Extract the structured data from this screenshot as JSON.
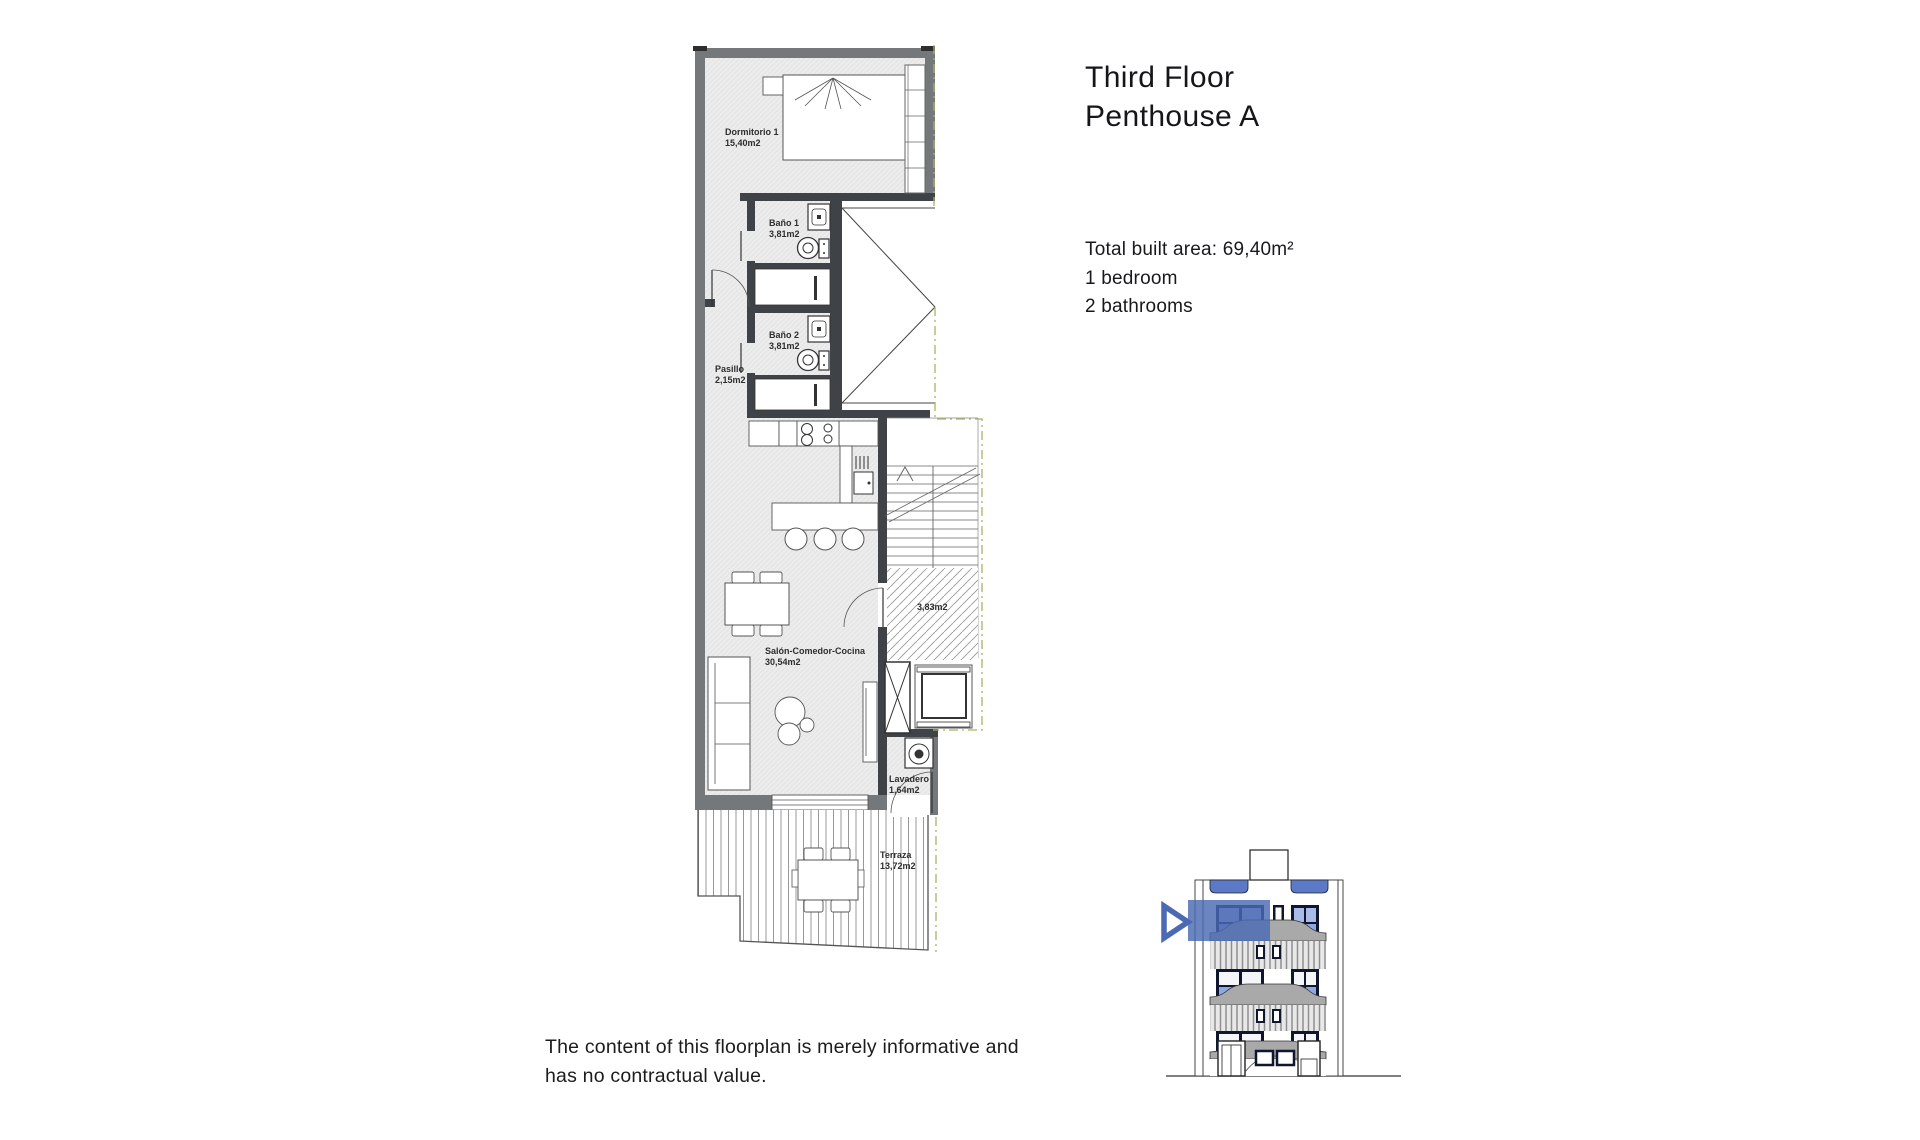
{
  "page": {
    "background": "#ffffff"
  },
  "header": {
    "title_line1": "Third Floor",
    "title_line2": "Penthouse A"
  },
  "summary": {
    "total_area": "Total built area: 69,40m²",
    "bedrooms": "1 bedroom",
    "bathrooms": "2 bathrooms"
  },
  "disclaimer": {
    "line1": "The content of this floorplan is merely informative and",
    "line2": "has no contractual value."
  },
  "floorplan": {
    "rooms": {
      "dormitorio1": {
        "name": "Dormitorio 1",
        "area": "15,40m2"
      },
      "bano1": {
        "name": "Baño 1",
        "area": "3,81m2"
      },
      "bano2": {
        "name": "Baño 2",
        "area": "3,81m2"
      },
      "pasillo": {
        "name": "Pasillo",
        "area": "2,15m2"
      },
      "salon": {
        "name": "Salón-Comedor-Cocina",
        "area": "30,54m2"
      },
      "lavadero": {
        "name": "Lavadero",
        "area": "1,64m2"
      },
      "terraza": {
        "name": "Terraza",
        "area": "13,72m2"
      },
      "landing": {
        "area": "3,83m2"
      }
    }
  },
  "colors": {
    "highlight_blue": "#4a6ab3",
    "window_blue": "#a9bce8",
    "window_blue_dark": "#8ea8e2",
    "window_frame": "#10162e",
    "wall_gray": "#75787b",
    "wall_dark": "#3f4246",
    "floor_fill": "#ececec",
    "boundary_dash": "#aab263",
    "parapet_gray": "#a9a9a9"
  }
}
